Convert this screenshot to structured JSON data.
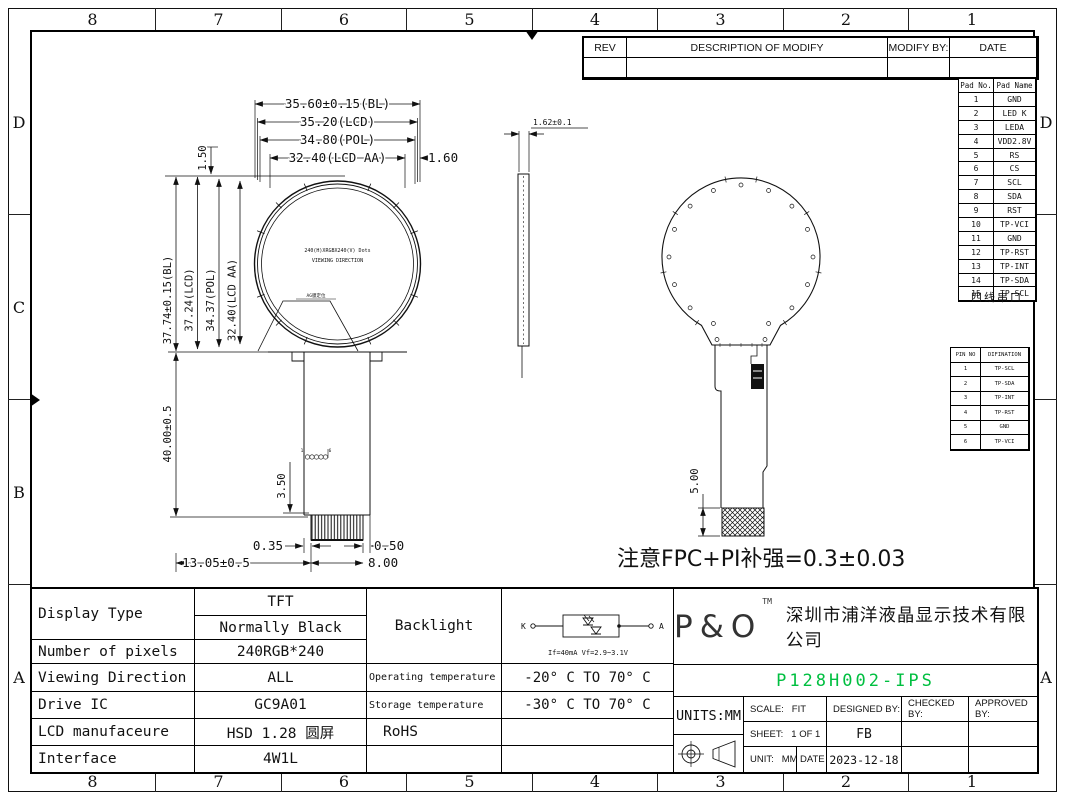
{
  "border": {
    "top_labels": [
      "8",
      "7",
      "6",
      "5",
      "4",
      "3",
      "2",
      "1"
    ],
    "bottom_labels": [
      "8",
      "7",
      "6",
      "5",
      "4",
      "3",
      "2",
      "1"
    ],
    "left_labels": [
      "D",
      "C",
      "B",
      "A"
    ],
    "right_labels": [
      "D",
      "",
      "",
      "A"
    ]
  },
  "rev_table": {
    "headers": [
      "REV",
      "DESCRIPTION OF MODIFY",
      "MODIFY BY:",
      "DATE"
    ]
  },
  "pad_table": {
    "headers": [
      "Pad No.",
      "Pad Name"
    ],
    "rows": [
      [
        "1",
        "GND"
      ],
      [
        "2",
        "LED K"
      ],
      [
        "3",
        "LEDA"
      ],
      [
        "4",
        "VDD2.8V"
      ],
      [
        "5",
        "RS"
      ],
      [
        "6",
        "CS"
      ],
      [
        "7",
        "SCL"
      ],
      [
        "8",
        "SDA"
      ],
      [
        "9",
        "RST"
      ],
      [
        "10",
        "TP-VCI"
      ],
      [
        "11",
        "GND"
      ],
      [
        "12",
        "TP-RST"
      ],
      [
        "13",
        "TP-INT"
      ],
      [
        "14",
        "TP-SDA"
      ],
      [
        "15",
        "TP-SCL"
      ]
    ],
    "note": "四线串口"
  },
  "pin_table": {
    "headers": [
      "PIN NO",
      "DIFINATION"
    ],
    "rows": [
      [
        "1",
        "TP-SCL"
      ],
      [
        "2",
        "TP-SDA"
      ],
      [
        "3",
        "TP-INT"
      ],
      [
        "4",
        "TP-RST"
      ],
      [
        "5",
        "GND"
      ],
      [
        "6",
        "TP-VCI"
      ]
    ]
  },
  "front_view": {
    "dim_bl_width": "35.60±0.15(BL)",
    "dim_lcd_width": "35.20(LCD)",
    "dim_pol_width": "34.80(POL)",
    "dim_aa_width": "32.40(LCD AA)",
    "dim_rim": "1.60",
    "dim_top_offset": "1.50",
    "dim_bl_height": "37.74±0.15(BL)",
    "dim_lcd_height": "37.24(LCD)",
    "dim_pol_height": "34.37(POL)",
    "dim_aa_height": "32.40(LCD AA)",
    "dim_fpc_length": "40.00±0.5",
    "dim_fpc_bottom": "13.05±0.5",
    "dim_gap_left": "0.35",
    "dim_gap_right": "0.50",
    "dim_connector_width": "8.00",
    "dim_stiffener": "3.50",
    "center_line1": "240(H)XRGBX240(V) Dots",
    "center_line2": "VIEWING DIRECTION",
    "ag_label": "AG膜定位",
    "finger_left": "1",
    "finger_right": "6"
  },
  "side_view": {
    "dim_thickness": "1.62±0.1"
  },
  "back_view": {
    "dim_stiffener_len": "5.00"
  },
  "note": "注意FPC+PI补强=0.3±0.03",
  "spec_table": {
    "display_type_label": "Display Type",
    "display_type_value1": "TFT",
    "display_type_value2": "Normally Black",
    "pixels_label": "Number of pixels",
    "pixels_value": "240RGB*240",
    "viewing_label": "Viewing Direction",
    "viewing_value": "ALL",
    "drive_label": "Drive IC",
    "drive_value": "GC9A01",
    "manufacture_label": "LCD manufaceure",
    "manufacture_value": "HSD 1.28 圆屏",
    "interface_label": "Interface",
    "interface_value": "4W1L",
    "backlight_label": "Backlight",
    "operating_label": "Operating temperature",
    "operating_value": "-20° C TO 70° C",
    "storage_label": "Storage temperature",
    "storage_value": "-30° C TO 70° C",
    "rohs": "RoHS",
    "circuit": {
      "k": "K",
      "a": "A",
      "spec": "If=40mA  Vf=2.9~3.1V"
    }
  },
  "title_block": {
    "logo": "P&O",
    "logo_tm": "TM",
    "company": "深圳市浦洋液晶显示技术有限公司",
    "part_number": "P128H002-IPS",
    "part_number_color": "#00bf40",
    "units": "UNITS:MM",
    "scale_label": "SCALE:",
    "scale_value": "FIT",
    "designed_label": "DESIGNED BY:",
    "designed_value": "FB",
    "checked_label": "CHECKED BY:",
    "approved_label": "APPROVED BY:",
    "sheet_label": "SHEET:",
    "sheet_value": "1 OF 1",
    "unit_label": "UNIT:",
    "unit_value": "MM",
    "date_label": "DATE",
    "date_value": "2023-12-18"
  }
}
